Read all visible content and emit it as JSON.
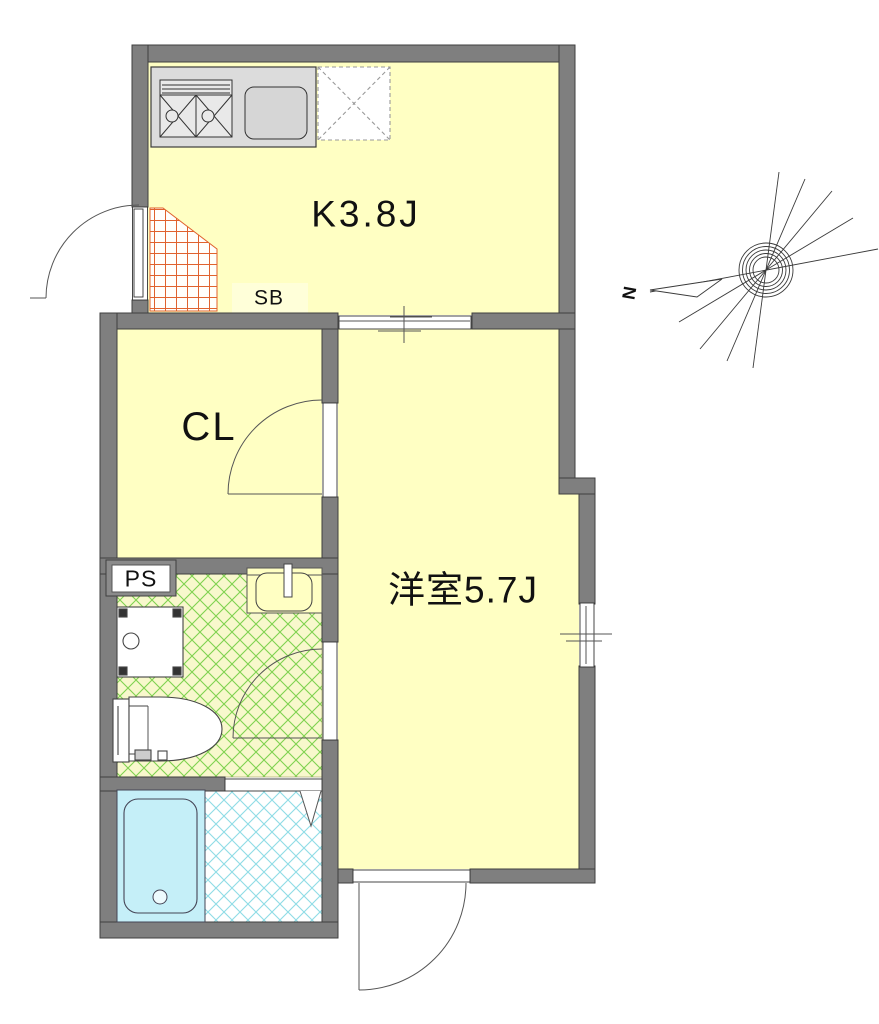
{
  "floorplan": {
    "rooms": {
      "kitchen": {
        "label": "K3.8J"
      },
      "closet": {
        "label": "CL"
      },
      "western_room": {
        "label": "洋室5.7J"
      },
      "shoe_box": {
        "label": "SB"
      },
      "pipe_space": {
        "label": "PS"
      }
    },
    "compass": {
      "north_label": "N"
    },
    "fixtures": [
      "gas-stove-icon",
      "kitchen-sink-icon",
      "refrigerator-space-icon",
      "entrance-tile-icon",
      "washing-machine-pan-icon",
      "wash-basin-icon",
      "toilet-icon",
      "bathtub-icon",
      "folding-door-icon",
      "swing-door-icon",
      "sliding-window-icon"
    ],
    "colors": {
      "wall_gray": "#7f7f7f",
      "room_yellow": "#ffffc3",
      "shoe_box_yellow": "#ffffd9",
      "washroom_floor": "#f8f8cc",
      "washroom_hatch_green": "#7fd24f",
      "bathroom_hatch_cyan": "#8edce6",
      "bathtub_cyan": "#c5eff8",
      "entrance_tile_orange": "#e0622d",
      "counter_gray": "#dcdcdc"
    }
  }
}
